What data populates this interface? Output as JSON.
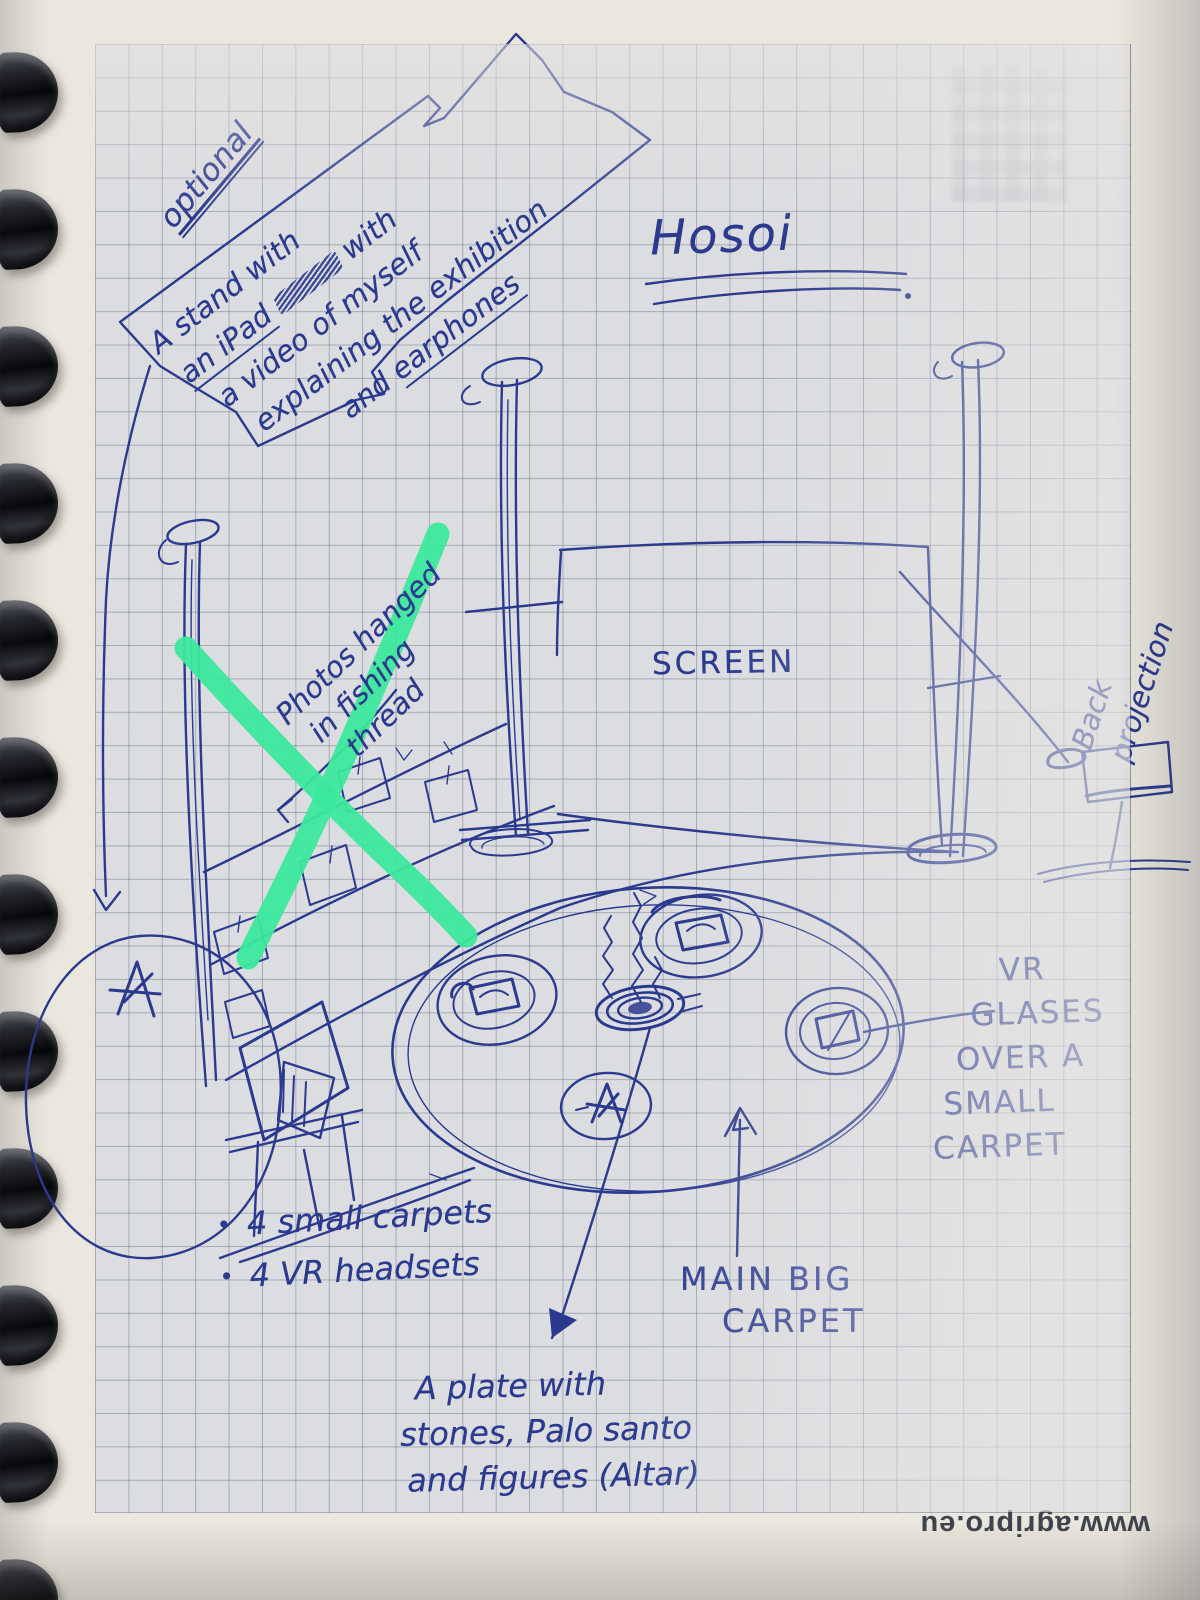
{
  "title": "Hosoi",
  "optional_box": {
    "heading": "optional",
    "line1": "A stand with",
    "line2_pre": "an iPad",
    "line2_post": "with",
    "line3": "a video of myself",
    "line4": "explaining the exhibition",
    "line5_pre": "and",
    "line5_post": "earphones"
  },
  "photos_note": {
    "line1": "Photos hanged",
    "line2": "in fishing",
    "line3": "thread"
  },
  "screen_label": "SCREEN",
  "back_projection": {
    "line1": "Back",
    "line2": "projection"
  },
  "vr_note": {
    "line1": "VR",
    "line2": "GLASES",
    "line3": "OVER A",
    "line4": "SMALL",
    "line5": "CARPET"
  },
  "supplies": {
    "bullet": "•",
    "items": [
      "4 small carpets",
      "4 VR headsets"
    ]
  },
  "main_carpet_label": {
    "line1": "MAIN BIG",
    "line2": "CARPET"
  },
  "altar_note": {
    "line1": "A plate with",
    "line2": "stones, Palo santo",
    "line3": "and figures (Altar)"
  },
  "watermark": "www.agripro.eu",
  "colors": {
    "ink": "#2b3a8f",
    "marker_green": "#3ce89c",
    "paper_grid": "#dcdde1",
    "paper_margin": "#eae7de",
    "grid_line": "#69738a",
    "binding": "#17181c"
  }
}
